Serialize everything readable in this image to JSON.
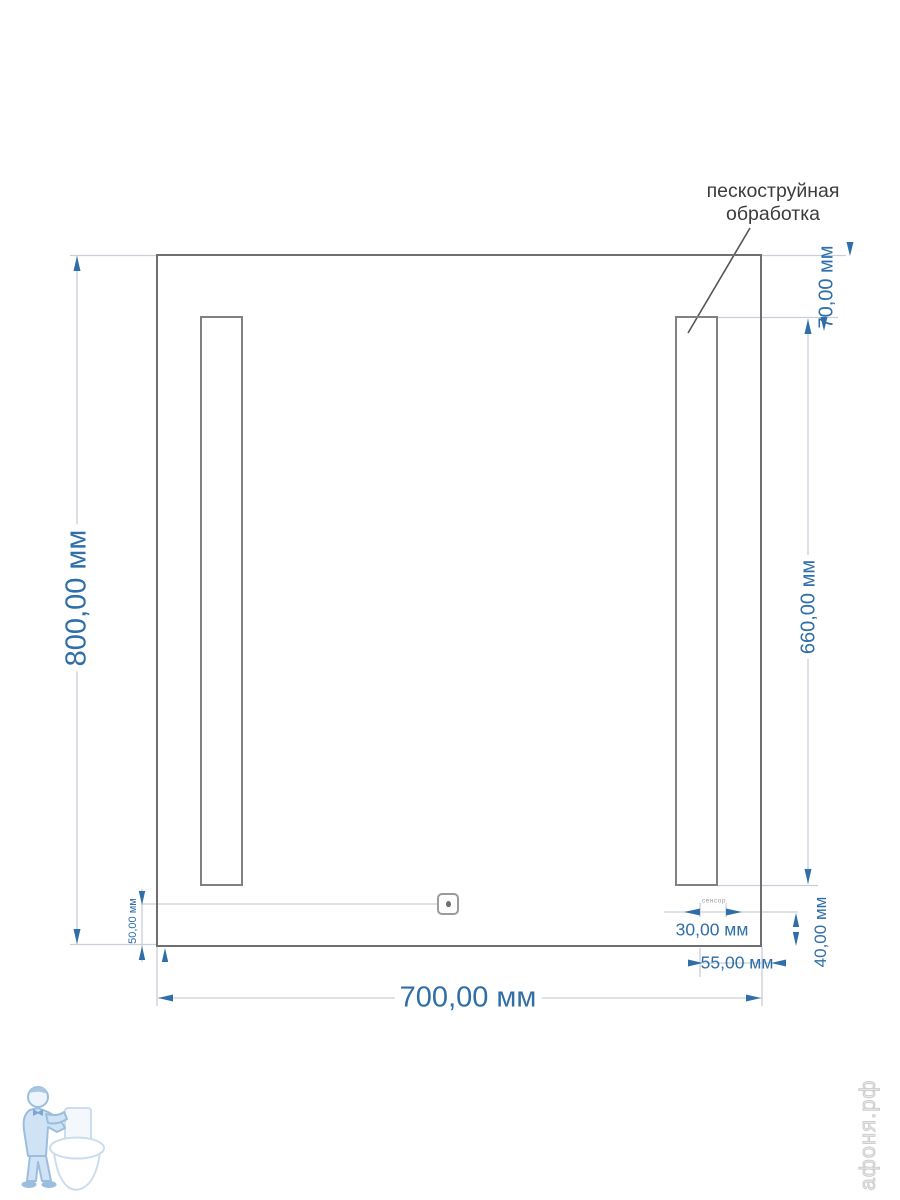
{
  "annotation": {
    "line1": "пескоструйная",
    "line2": "обработка"
  },
  "dimensions": {
    "mirror_height": "800,00 мм",
    "mirror_width": "700,00 мм",
    "strip_top_offset": "70,00 мм",
    "strip_height": "660,00 мм",
    "sensor_bottom_offset": "50,00 мм",
    "dim_30": "30,00 мм",
    "dim_55": "55,00 мм",
    "dim_40": "40,00 мм"
  },
  "tiny_label": "сенсор",
  "watermark": {
    "site": "афоня.рф"
  },
  "icons": {
    "sensor_dot": "touch-sensor-dot-icon",
    "logo": "plumber-with-toilet-icon"
  },
  "colors": {
    "dimension_blue": "#2f6ea8",
    "annotation_text": "#3c3c3c",
    "mirror_outline": "#6f6f6f",
    "strip_outline": "#818181",
    "extension_line": "#c9cfd8",
    "leader_line": "#555555",
    "watermark_fill": "#cfe3f5",
    "watermark_stroke": "#9cbede",
    "watermark_text": "#d9d9d9"
  }
}
